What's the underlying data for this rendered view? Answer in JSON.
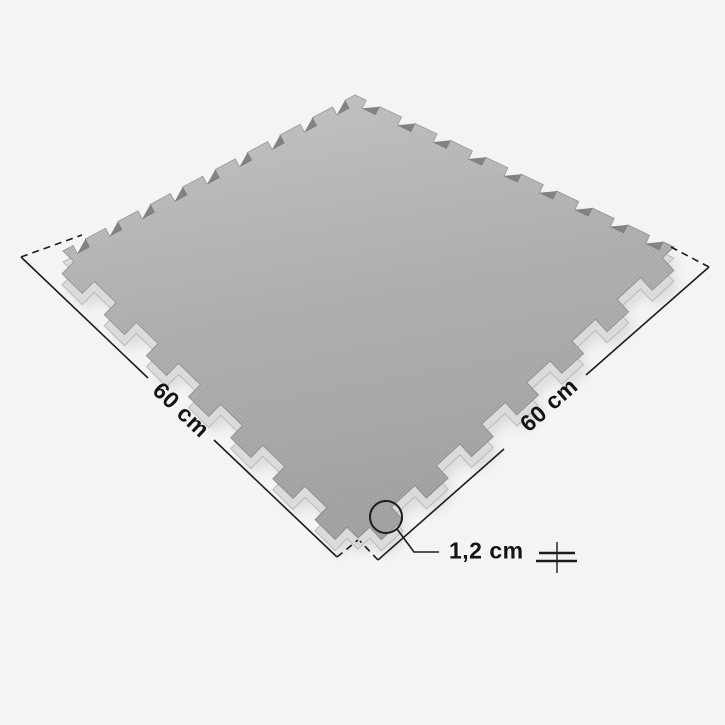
{
  "diagram": {
    "labels": {
      "side_a": "60 cm",
      "side_b": "60 cm",
      "thickness": "1,2 cm"
    },
    "colors": {
      "background": "#f4f4f4",
      "mat_top": "#a8a8a8",
      "mat_texture": "#b3b3b3",
      "mat_side": "#dbdbdb",
      "mat_side_stroke": "#b2b2b2",
      "mat_outline": "#909090",
      "notch_shadow": "#6e6e6e",
      "line": "#1c1c1c",
      "text": "#141414"
    },
    "mat": {
      "corners": {
        "top": [
          355,
          95
        ],
        "right": [
          674,
          247
        ],
        "bottom": [
          358,
          538
        ],
        "left": [
          63,
          251
        ]
      },
      "thickness_offset": 11,
      "edges": [
        {
          "name": "far-right-edge",
          "teeth": 9,
          "depth": -9,
          "frac": 0.38
        },
        {
          "name": "near-right-edge",
          "teeth": 7,
          "depth": 17,
          "frac": 0.48
        },
        {
          "name": "near-left-edge",
          "teeth": 7,
          "depth": 17,
          "frac": 0.48
        },
        {
          "name": "far-left-edge",
          "teeth": 9,
          "depth": -9,
          "frac": 0.38
        }
      ]
    },
    "annotations": {
      "dash_pattern": "7,5",
      "solid_lines": [
        [
          21,
          257,
          148,
          378
        ],
        [
          214,
          440,
          337,
          557
        ],
        [
          378,
          560,
          504,
          449
        ],
        [
          586,
          375,
          709,
          267
        ]
      ],
      "dashed_lines": [
        [
          21,
          257,
          82,
          235
        ],
        [
          709,
          267,
          671,
          247
        ],
        [
          337,
          557,
          358,
          540
        ],
        [
          378,
          560,
          360,
          541
        ]
      ],
      "circle": {
        "cx": 386,
        "cy": 517,
        "r": 16
      },
      "leader": [
        [
          397,
          529
        ],
        [
          414,
          552
        ],
        [
          439,
          552
        ]
      ],
      "thickness_symbol": {
        "vline": [
          557,
          542,
          557,
          573
        ],
        "hlines": [
          [
            539,
            553,
            575,
            553
          ],
          [
            536,
            561,
            577,
            561
          ]
        ]
      }
    }
  }
}
